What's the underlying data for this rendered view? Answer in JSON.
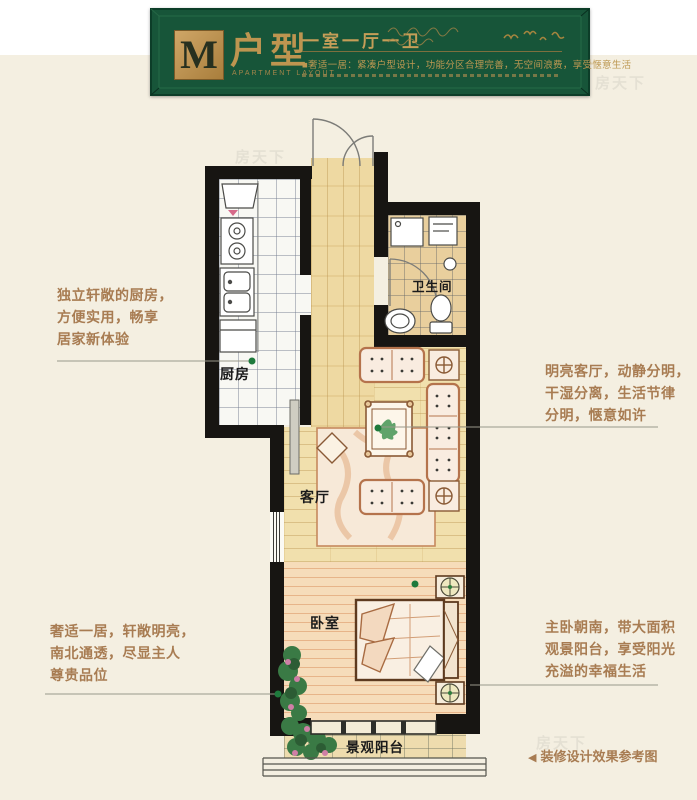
{
  "watermark": {
    "text": "房天下"
  },
  "header": {
    "letter": "M",
    "title": "户型",
    "subtitle": "APARTMENT LAYOUT",
    "spec": "一室一厅一卫",
    "desc_bullet": "■",
    "description": "奢适一居：紧凑户型设计，功能分区合理完善，无空间浪费，享受惬意生活",
    "colors": {
      "panel_green": "#175539",
      "gold": "#bd9550"
    }
  },
  "plan": {
    "rooms": [
      {
        "id": "kitchen",
        "label": "厨房"
      },
      {
        "id": "bathroom",
        "label": "卫生间"
      },
      {
        "id": "living-room",
        "label": "客厅"
      },
      {
        "id": "bedroom",
        "label": "卧室"
      },
      {
        "id": "balcony",
        "label": "景观阳台"
      }
    ],
    "marker_color": "#1e7a3c"
  },
  "annotations": {
    "left": [
      {
        "lines": [
          "独立轩敞的厨房，",
          "方便实用，畅享",
          "居家新体验"
        ]
      },
      {
        "lines": [
          "奢适一居，轩敞明亮，",
          "南北通透，尽显主人",
          "尊贵品位"
        ]
      }
    ],
    "right": [
      {
        "lines": [
          "明亮客厅，动静分明，",
          "干湿分离，生活节律",
          "分明，惬意如许"
        ]
      },
      {
        "lines": [
          "主卧朝南，带大面积",
          "观景阳台，享受阳光",
          "充溢的幸福生活"
        ]
      }
    ]
  },
  "footer": {
    "arrow": "◀",
    "note": "装修设计效果参考图"
  }
}
